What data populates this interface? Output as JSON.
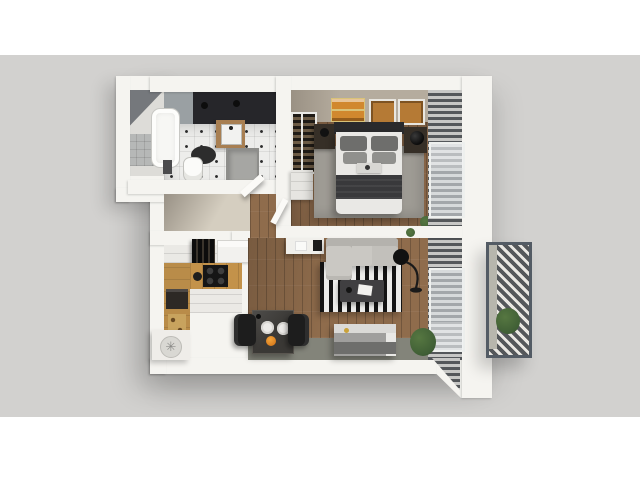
{
  "scene": {
    "type": "3d top-down floor plan render",
    "subject": "one-bedroom apartment with balcony",
    "rooms": [
      {
        "name": "bathroom",
        "items": [
          "bathtub",
          "vanity-sink",
          "shower-tray",
          "toilet",
          "round-rug",
          "pendant-lights",
          "dark-accent-wall",
          "entry-niche"
        ]
      },
      {
        "name": "bedroom",
        "items": [
          "double-bed",
          "headboard",
          "pillows",
          "dark-blanket",
          "nightstand-left",
          "nightstand-right",
          "table-lamps",
          "area-rug",
          "wall-frames",
          "slatted-shelf-unit",
          "dresser",
          "plant"
        ]
      },
      {
        "name": "hallway",
        "items": [
          "open-bathroom-door",
          "open-bedroom-door"
        ]
      },
      {
        "name": "kitchen",
        "items": [
          "l-shaped-counter",
          "cooktop",
          "oven",
          "wine-rack",
          "white-appliance",
          "cutting-board",
          "kettle",
          "corner-cabinet-vent-medallion"
        ]
      },
      {
        "name": "living-dining",
        "items": [
          "sofa-with-chaise",
          "striped-rug",
          "coffee-table",
          "arc-floor-lamp",
          "tv-console",
          "dining-table",
          "dining-chairs",
          "plates-with-food",
          "plant",
          "wall-desk"
        ]
      },
      {
        "name": "window-wall",
        "items": [
          "louvered-blinds",
          "glass-panels"
        ]
      },
      {
        "name": "balcony",
        "items": [
          "slatted-deck",
          "concrete-edge",
          "plant"
        ]
      }
    ]
  },
  "colors": {
    "band": "#ffffff",
    "bg": "#d2d1cf",
    "wall": "#f5f4f0",
    "woodBed": "#8a684a",
    "woodLiv": "#8f6c4c",
    "hall": "#d5cec0",
    "olive": "#83847a",
    "tileLight": "#ededeb",
    "bathDark": "#26262a",
    "bathGray": "#9aa0a3",
    "niche": "#75787c",
    "mat": "#b6b8b7",
    "rugBed": "#9e9b94",
    "rugStripeDark": "#141414",
    "rugStripeLight": "#ececea",
    "louvDark": "#54575a",
    "louvLight": "#c7c7c5",
    "glass": "rgba(228,234,236,0.55)",
    "counter": "#c3924a",
    "counterSide": "#b98c49",
    "dark": "#1d1d1d",
    "blanket": "#39393b",
    "duvet": "#e9e8e5",
    "sofa": "#cac8c3",
    "sofaBack": "#b4b2ad",
    "beige": "#b5ac9e",
    "frameGold": "#d9c278",
    "photoOrange": "#d1882e",
    "green1": "#3f5e35",
    "green2": "#567741",
    "balcFrame": "#535b64",
    "concrete": "#b7b6ad",
    "consoleTop": "#dbdad7",
    "consoleBody": "#a09f9d",
    "consoleFront": "#6e6e6c",
    "appliance": "#f2f1ee",
    "tableDark": "#3a3835"
  },
  "icons": {
    "vent_glyph": "✳"
  }
}
